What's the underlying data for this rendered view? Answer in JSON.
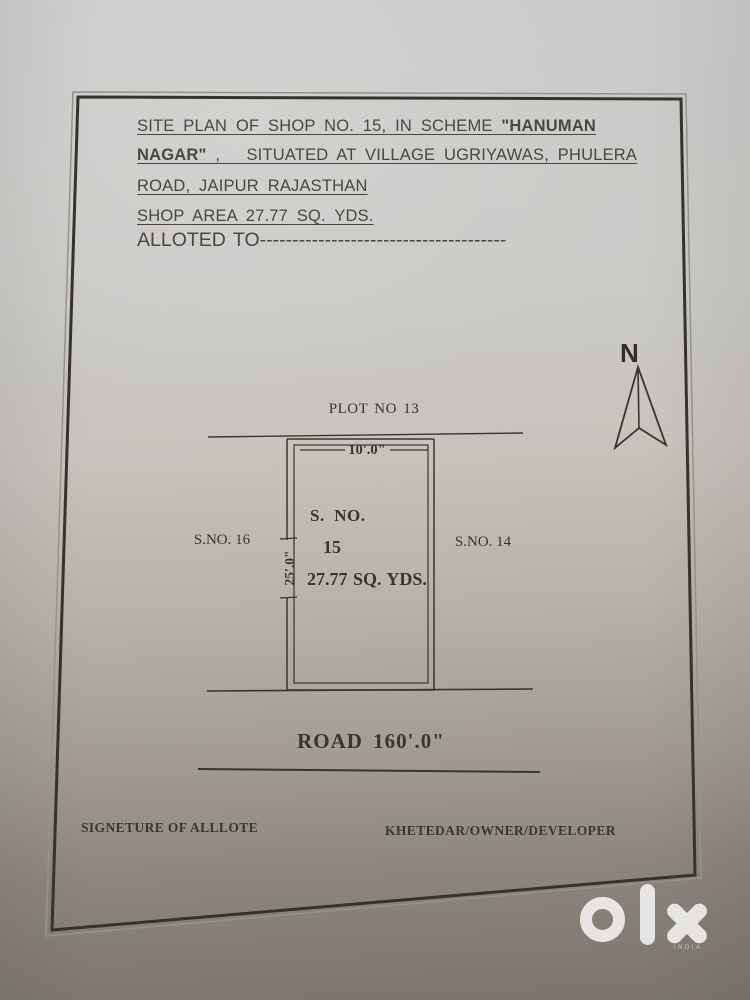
{
  "header": {
    "line1_text": "SITE PLAN OF SHOP NO. 15, IN SCHEME ",
    "line1_bold": "\"HANUMAN",
    "line2_bold": "NAGAR\"",
    "line2_text": " ,   SITUATED AT VILLAGE UGRIYAWAS, PHULERA",
    "line3": "ROAD, JAIPUR RAJASTHAN",
    "line4": "SHOP AREA 27.77 SQ. YDS.",
    "allotted_label": "ALLOTED TO",
    "allotted_dashes": "--------------------------------------"
  },
  "compass": {
    "label": "N"
  },
  "plot": {
    "north_neighbor": "PLOT NO 13",
    "west_neighbor": "S.NO. 16",
    "east_neighbor": "S.NO. 14",
    "front_dimension": "10'.0\"",
    "side_dimension": "25'.0\"",
    "survey_label": "S.  NO.",
    "survey_number": "15",
    "area": "27.77 SQ. YDS.",
    "road": "ROAD 160'.0\""
  },
  "footer": {
    "left": "SIGNETURE OF ALLLOTE",
    "right": "KHETEDAR/OWNER/DEVELOPER"
  },
  "watermark": {
    "brand": "olx",
    "country": "INDIA"
  },
  "colors": {
    "ink": "#38342e",
    "paper_top": "#cbccca",
    "paper_bottom": "#7a746c",
    "watermark": "#ffffff"
  }
}
